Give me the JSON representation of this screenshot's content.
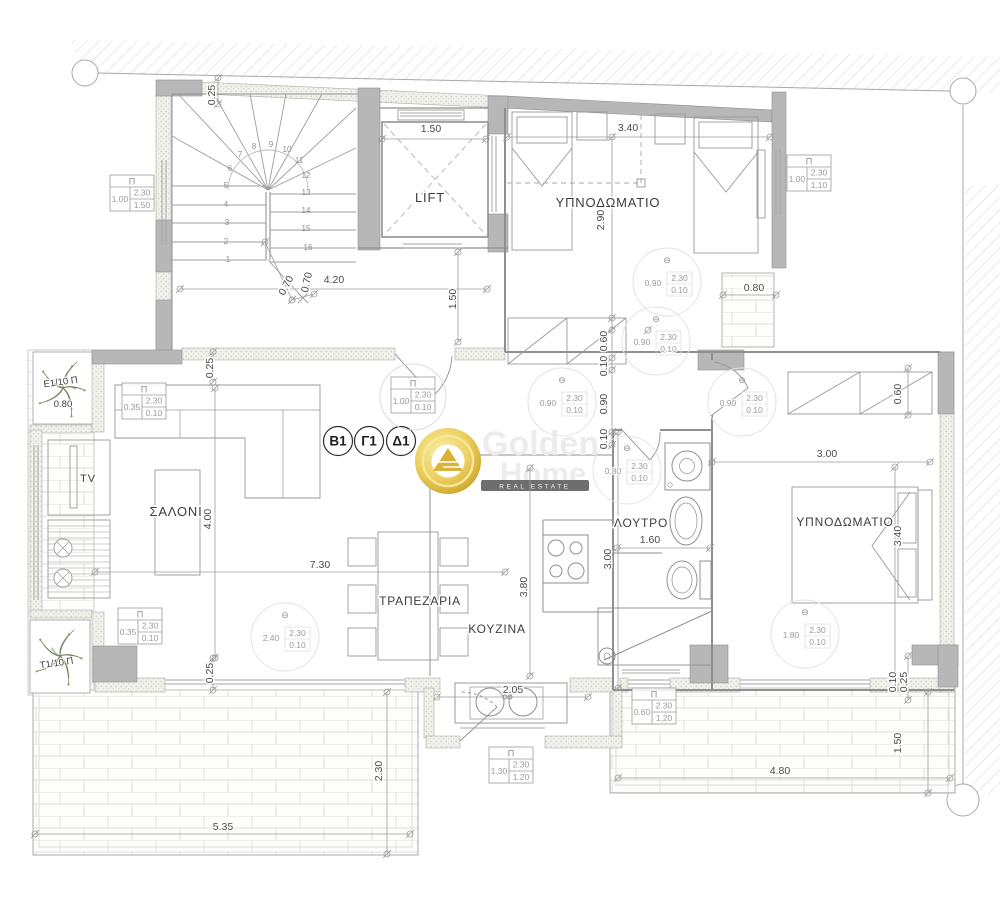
{
  "watermark": {
    "word1": "Golden",
    "word2": "Home",
    "banner": "REAL ESTATE"
  },
  "symbols": {
    "pi": "Π",
    "theta": "⊖"
  },
  "unit_badges": [
    {
      "label": "B1",
      "x": 338,
      "y": 441
    },
    {
      "label": "Γ1",
      "x": 369,
      "y": 441
    },
    {
      "label": "Δ1",
      "x": 401,
      "y": 441
    }
  ],
  "room_labels": [
    {
      "id": "lift",
      "text": "LIFT",
      "x": 430,
      "y": 202,
      "size": 13
    },
    {
      "id": "bedroom-top",
      "text": "ΥΠΝΟΔΩΜΑΤΙΟ",
      "x": 608,
      "y": 207,
      "size": 13
    },
    {
      "id": "living",
      "text": "ΣΑΛΟΝΙ",
      "x": 176,
      "y": 516,
      "size": 13
    },
    {
      "id": "dining",
      "text": "ΤΡΑΠΕΖΑΡΙΑ",
      "x": 420,
      "y": 605,
      "size": 12
    },
    {
      "id": "kitchen",
      "text": "ΚΟΥΖΙΝΑ",
      "x": 497,
      "y": 633,
      "size": 12
    },
    {
      "id": "bath",
      "text": "ΛΟΥΤΡΟ",
      "x": 641,
      "y": 527,
      "size": 12
    },
    {
      "id": "bedroom-right",
      "text": "ΥΠΝΟΔΩΜΑΤΙΟ",
      "x": 845,
      "y": 526,
      "size": 12
    },
    {
      "id": "tv",
      "text": "TV",
      "x": 88,
      "y": 482,
      "size": 11
    }
  ],
  "dimensions": [
    {
      "t": "0.25",
      "x": 215,
      "y": 95,
      "r": -90
    },
    {
      "t": "1.50",
      "x": 431,
      "y": 132,
      "r": 0
    },
    {
      "t": "3.40",
      "x": 628,
      "y": 131,
      "r": 0
    },
    {
      "t": "2.90",
      "x": 604,
      "y": 220,
      "r": -90
    },
    {
      "t": "0.80",
      "x": 754,
      "y": 291,
      "r": 0
    },
    {
      "t": "4.20",
      "x": 334,
      "y": 283,
      "r": 0
    },
    {
      "t": "0.70",
      "x": 289,
      "y": 287,
      "r": -62
    },
    {
      "t": "0.70",
      "x": 310,
      "y": 283,
      "r": -78
    },
    {
      "t": "1.50",
      "x": 456,
      "y": 299,
      "r": -90
    },
    {
      "t": "0.25",
      "x": 213,
      "y": 368,
      "r": -90
    },
    {
      "t": "4.00",
      "x": 211,
      "y": 519,
      "r": -90
    },
    {
      "t": "7.30",
      "x": 320,
      "y": 568,
      "r": 0
    },
    {
      "t": "3.80",
      "x": 527,
      "y": 587,
      "r": -90
    },
    {
      "t": "0.60",
      "x": 607,
      "y": 341,
      "r": -90
    },
    {
      "t": "0.10",
      "x": 607,
      "y": 366,
      "r": -90
    },
    {
      "t": "0.90",
      "x": 607,
      "y": 404,
      "r": -90
    },
    {
      "t": "0.10",
      "x": 607,
      "y": 439,
      "r": -90
    },
    {
      "t": "3.00",
      "x": 611,
      "y": 559,
      "r": -90
    },
    {
      "t": "1.60",
      "x": 650,
      "y": 543,
      "r": 0
    },
    {
      "t": "3.00",
      "x": 827,
      "y": 457,
      "r": 0
    },
    {
      "t": "3.40",
      "x": 901,
      "y": 536,
      "r": -90
    },
    {
      "t": "0.60",
      "x": 901,
      "y": 394,
      "r": -90
    },
    {
      "t": "2.05",
      "x": 513,
      "y": 693,
      "r": 0
    },
    {
      "t": "0.25",
      "x": 213,
      "y": 673,
      "r": -90
    },
    {
      "t": "5.35",
      "x": 223,
      "y": 830,
      "r": 0
    },
    {
      "t": "2.30",
      "x": 382,
      "y": 771,
      "r": -90
    },
    {
      "t": "4.80",
      "x": 780,
      "y": 774,
      "r": 0
    },
    {
      "t": "1.50",
      "x": 901,
      "y": 743,
      "r": -90
    },
    {
      "t": "0.10",
      "x": 896,
      "y": 682,
      "r": -90
    },
    {
      "t": "0.25",
      "x": 907,
      "y": 682,
      "r": -90
    }
  ],
  "door_markers": [
    {
      "x": 132,
      "y": 193,
      "left": "1.00",
      "top": "2.30",
      "bottom": "1.50",
      "circled": false
    },
    {
      "x": 809,
      "y": 173,
      "left": "1.00",
      "top": "2.30",
      "bottom": "1.10",
      "circled": false
    },
    {
      "x": 144,
      "y": 401,
      "left": "0.35",
      "top": "2.30",
      "bottom": "0.10",
      "circled": false
    },
    {
      "x": 140,
      "y": 626,
      "left": "0.35",
      "top": "2.30",
      "bottom": "0.10",
      "circled": false
    },
    {
      "x": 654,
      "y": 706,
      "left": "0.60",
      "top": "2.30",
      "bottom": "1.20",
      "circled": false
    },
    {
      "x": 511,
      "y": 765,
      "left": "1.30",
      "top": "2.30",
      "bottom": "1.20",
      "circled": false
    },
    {
      "x": 413,
      "y": 395,
      "left": "1.00",
      "top": "2.30",
      "bottom": "0.10",
      "circled": true
    }
  ],
  "window_markers": [
    {
      "x": 667,
      "y": 282,
      "left": "0.90",
      "top": "2.30",
      "bottom": "0.10"
    },
    {
      "x": 656,
      "y": 341,
      "left": "0.90",
      "top": "2.30",
      "bottom": "0.10"
    },
    {
      "x": 562,
      "y": 402,
      "left": "0.90",
      "top": "2.30",
      "bottom": "0.10"
    },
    {
      "x": 742,
      "y": 402,
      "left": "0.90",
      "top": "2.30",
      "bottom": "0.10"
    },
    {
      "x": 627,
      "y": 470,
      "left": "0.80",
      "top": "2.30",
      "bottom": "0.10"
    },
    {
      "x": 285,
      "y": 637,
      "left": "2.40",
      "top": "2.30",
      "bottom": "0.10"
    },
    {
      "x": 805,
      "y": 634,
      "left": "1.80",
      "top": "2.30",
      "bottom": "0.10"
    }
  ],
  "stair_numbers": [
    {
      "n": "1",
      "x": 228,
      "y": 262
    },
    {
      "n": "2",
      "x": 226,
      "y": 244
    },
    {
      "n": "3",
      "x": 227,
      "y": 225
    },
    {
      "n": "4",
      "x": 226,
      "y": 207
    },
    {
      "n": "5",
      "x": 226,
      "y": 188
    },
    {
      "n": "6",
      "x": 230,
      "y": 171
    },
    {
      "n": "7",
      "x": 240,
      "y": 157
    },
    {
      "n": "8",
      "x": 254,
      "y": 149
    },
    {
      "n": "9",
      "x": 271,
      "y": 147
    },
    {
      "n": "10",
      "x": 287,
      "y": 152
    },
    {
      "n": "11",
      "x": 299,
      "y": 163
    },
    {
      "n": "12",
      "x": 306,
      "y": 178
    },
    {
      "n": "13",
      "x": 306,
      "y": 195
    },
    {
      "n": "14",
      "x": 306,
      "y": 213
    },
    {
      "n": "15",
      "x": 306,
      "y": 231
    },
    {
      "n": "16",
      "x": 308,
      "y": 250
    }
  ],
  "planters": [
    {
      "text": "Ε1/10 Π",
      "x": 61,
      "y": 385,
      "rot": -8
    },
    {
      "text": "0.80",
      "x": 63,
      "y": 407,
      "rot": 0
    },
    {
      "text": "Τ1/10 Π",
      "x": 57,
      "y": 666,
      "rot": -8
    }
  ],
  "colors": {
    "wall_gray": "#b7b7b7",
    "line_gray": "#8f8f8f",
    "light_line": "#c9c9c9",
    "gold": "#e9c94e",
    "banner_gray": "#6e6e6e",
    "plant_green": "#6d8758"
  }
}
